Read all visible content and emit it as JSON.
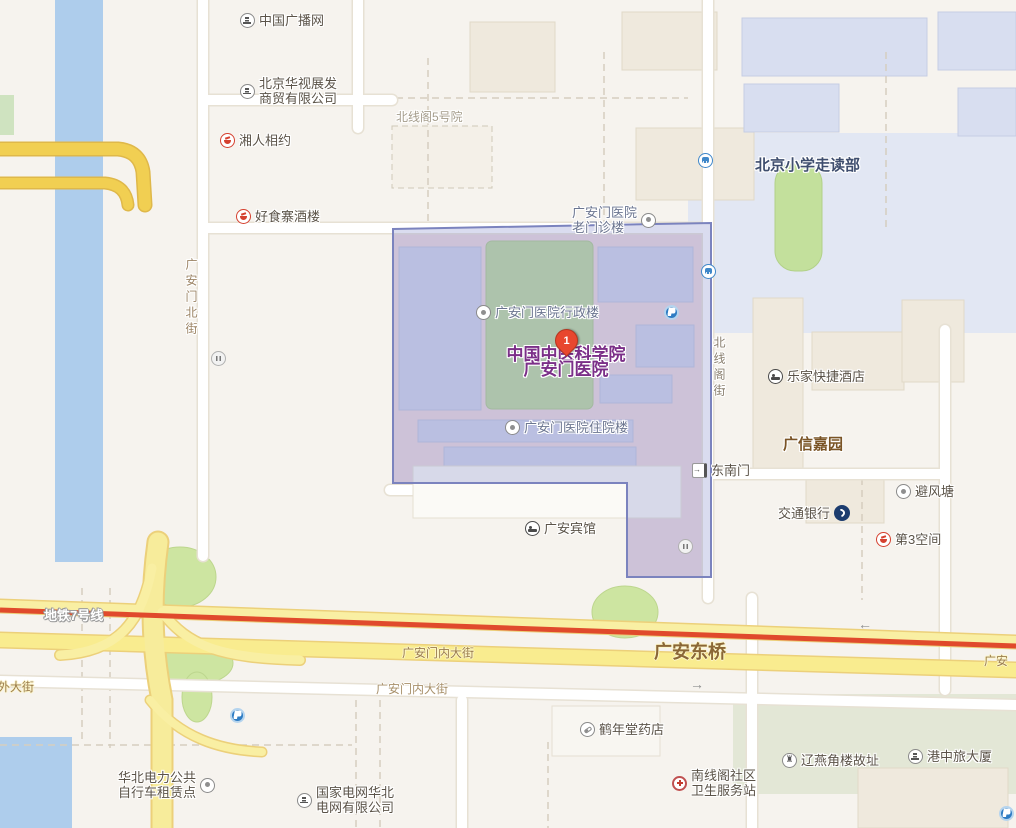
{
  "map": {
    "marker": {
      "number": "1",
      "title": "中国中医科学院广安门医院"
    },
    "pois": [
      {
        "text": "中国广播网",
        "icon": "building"
      },
      {
        "text": "北京华视展发\n商贸有限公司",
        "icon": "building"
      },
      {
        "text": "湘人相约",
        "icon": "restaurant"
      },
      {
        "text": "好食寨酒楼",
        "icon": "restaurant"
      },
      {
        "text": "北京小学走读部",
        "icon": "none"
      },
      {
        "text": "",
        "icon": "bus-stop"
      },
      {
        "text": "广安门医院\n老门诊楼",
        "icon": "dot"
      },
      {
        "text": "",
        "icon": "bus-stop"
      },
      {
        "text": "广安门医院行政楼",
        "icon": "dot"
      },
      {
        "text": "",
        "icon": "parking"
      },
      {
        "text": "中国中医科学院\n广安门医院",
        "icon": "none"
      },
      {
        "text": "乐家快捷酒店",
        "icon": "hotel"
      },
      {
        "text": "广信嘉园",
        "icon": "none"
      },
      {
        "text": "广安门医院住院楼",
        "icon": "dot"
      },
      {
        "text": "东南门",
        "icon": "gate"
      },
      {
        "text": "避风塘",
        "icon": "dot"
      },
      {
        "text": "交通银行",
        "icon": "bank"
      },
      {
        "text": "第3空间",
        "icon": "restaurant"
      },
      {
        "text": "广安宾馆",
        "icon": "hotel"
      },
      {
        "text": "",
        "icon": "toilet"
      },
      {
        "text": "",
        "icon": "toilet"
      },
      {
        "text": "",
        "icon": "parking"
      },
      {
        "text": "鹤年堂药店",
        "icon": "pharmacy"
      },
      {
        "text": "辽燕角楼故址",
        "icon": "monument"
      },
      {
        "text": "港中旅大厦",
        "icon": "building"
      },
      {
        "text": "南线阁社区\n卫生服务站",
        "icon": "clinic-cross"
      },
      {
        "text": "华北电力公共\n自行车租赁点",
        "icon": "dot"
      },
      {
        "text": "国家电网华北\n电网有限公司",
        "icon": "building"
      },
      {
        "text": "",
        "icon": "parking"
      },
      {
        "text": "北线阁5号院",
        "icon": "none"
      }
    ],
    "road_labels": [
      {
        "text": "地铁7号线"
      },
      {
        "text": "外大街"
      },
      {
        "text": "广安门内大街"
      },
      {
        "text": "广安东桥"
      },
      {
        "text": "广安门内大街"
      },
      {
        "text": "广安"
      },
      {
        "text": "←"
      },
      {
        "text": "→"
      },
      {
        "text": "广安门北街"
      },
      {
        "text": "北线阁街"
      }
    ],
    "colors": {
      "map_background": "#f6f3ee",
      "river_blue": "#aecdec",
      "arterial_yellow": "#f9efa3",
      "golden_road": "#f1cf52",
      "metro_line_red": "#e04a2c",
      "selection_overlay": "#9ea4d6",
      "selection_border": "#7b83be",
      "hospital_ground_pink": "#ead6da",
      "campus_green": "#b7d794",
      "main_label_purple": "#7b2f88",
      "road_label_brown": "#9b7d4e",
      "poi_text": "#5b5348"
    }
  }
}
